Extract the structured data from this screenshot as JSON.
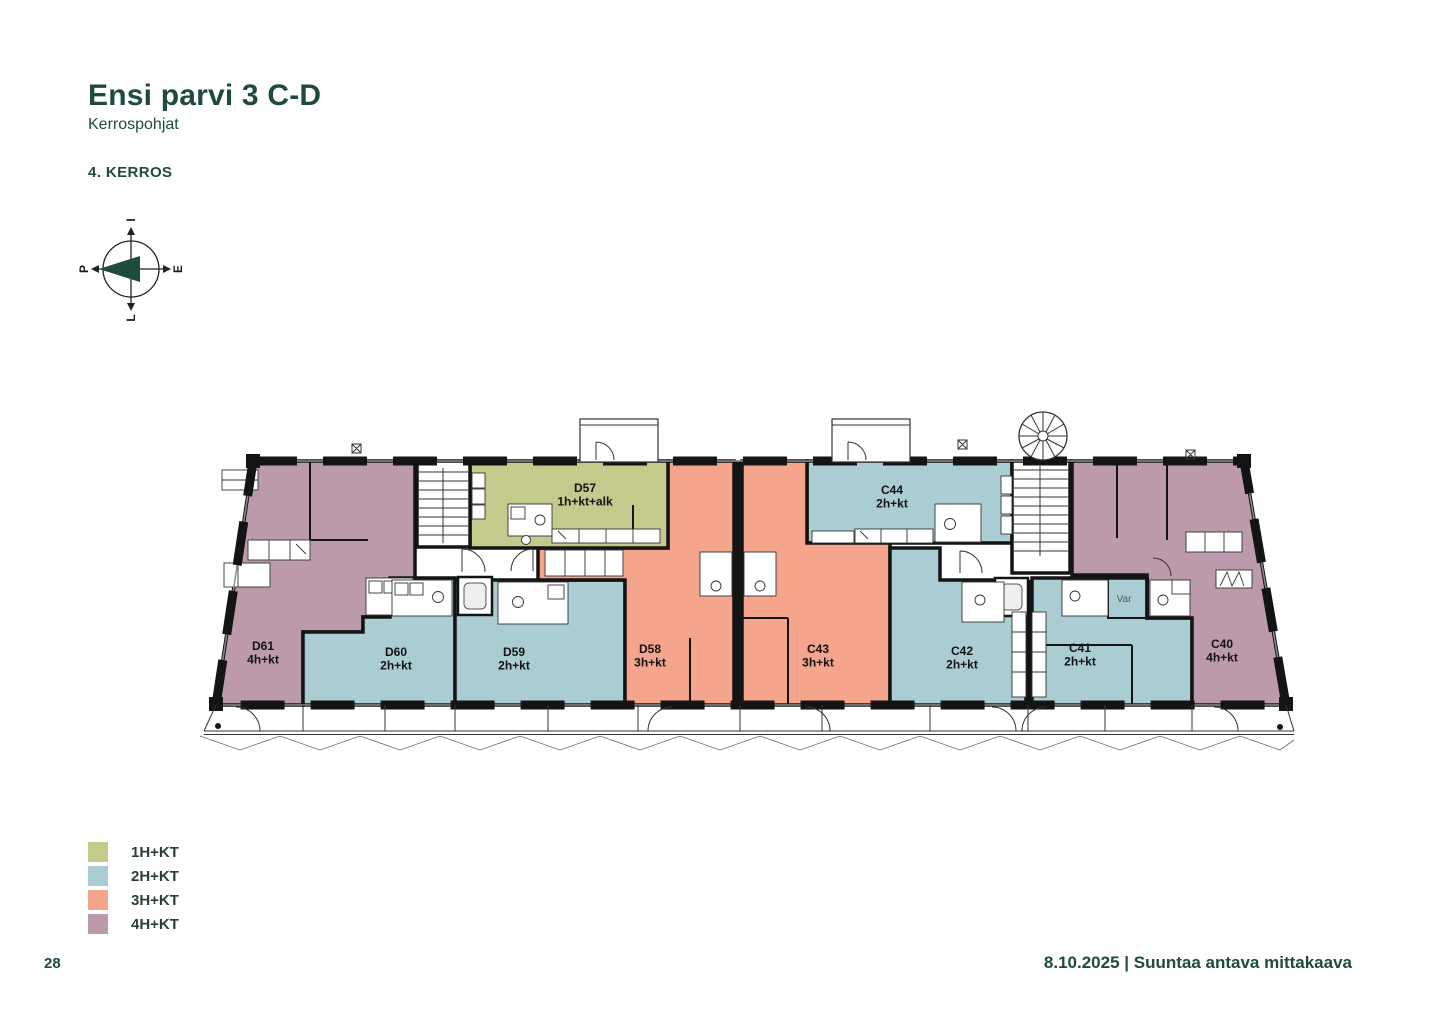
{
  "page": {
    "title": "Ensi parvi 3 C-D",
    "subtitle": "Kerrospohjat",
    "floor_label": "4. KERROS",
    "page_number": "28",
    "footer": "8.10.2025 | Suuntaa antava mittakaava"
  },
  "compass": {
    "north": "P",
    "east": "I",
    "south": "E",
    "west": "L"
  },
  "colors": {
    "accent": "#1e4b3a",
    "wall": "#141414",
    "olive": "#c4c98c",
    "teal": "#a9cdd2",
    "salmon": "#f6a58d",
    "mauve": "#bd9aab"
  },
  "legend": [
    {
      "label": "1H+KT",
      "color": "olive"
    },
    {
      "label": "2H+KT",
      "color": "teal"
    },
    {
      "label": "3H+KT",
      "color": "salmon"
    },
    {
      "label": "4H+KT",
      "color": "mauve"
    }
  ],
  "plan": {
    "storage_label": "Var"
  },
  "apartments": [
    {
      "id": "D61",
      "type": "4h+kt",
      "color": "mauve",
      "label_x": 263,
      "label_y": 650,
      "points": "253,461 415,461 415,617 363,617 363,632 303,632 303,705 216,705"
    },
    {
      "id": "D60",
      "type": "2h+kt",
      "color": "teal",
      "label_x": 396,
      "label_y": 656,
      "points": "303,632 363,632 363,617 390,617 390,578 455,578 455,705 303,705"
    },
    {
      "id": "D59",
      "type": "2h+kt",
      "color": "teal",
      "label_x": 514,
      "label_y": 656,
      "points": "455,580 625,580 625,705 455,705"
    },
    {
      "id": "D58",
      "type": "3h+kt",
      "color": "salmon",
      "label_x": 650,
      "label_y": 653,
      "points": "668,461 734,461 734,705 625,705 625,580 538,580 538,548 668,548"
    },
    {
      "id": "D57",
      "type": "1h+kt+alk",
      "color": "olive",
      "label_x": 585,
      "label_y": 492,
      "points": "470,461 668,461 668,548 470,548"
    },
    {
      "id": "C44",
      "type": "2h+kt",
      "color": "teal",
      "label_x": 892,
      "label_y": 494,
      "points": "807,461 1012,461 1012,543 807,543"
    },
    {
      "id": "C43",
      "type": "3h+kt",
      "color": "salmon",
      "label_x": 818,
      "label_y": 653,
      "points": "742,461 807,461 807,543 890,543 890,705 742,705"
    },
    {
      "id": "C42",
      "type": "2h+kt",
      "color": "teal",
      "label_x": 962,
      "label_y": 655,
      "points": "890,548 940,548 940,580 1026,580 1026,705 890,705"
    },
    {
      "id": "C41",
      "type": "2h+kt",
      "color": "teal",
      "label_x": 1080,
      "label_y": 652,
      "points": "1032,578 1147,578 1147,618 1192,618 1192,705 1032,705"
    },
    {
      "id": "C40",
      "type": "4h+kt",
      "color": "mauve",
      "label_x": 1222,
      "label_y": 648,
      "points": "1072,461 1244,461 1286,705 1192,705 1192,618 1147,618 1147,575 1072,575"
    }
  ]
}
